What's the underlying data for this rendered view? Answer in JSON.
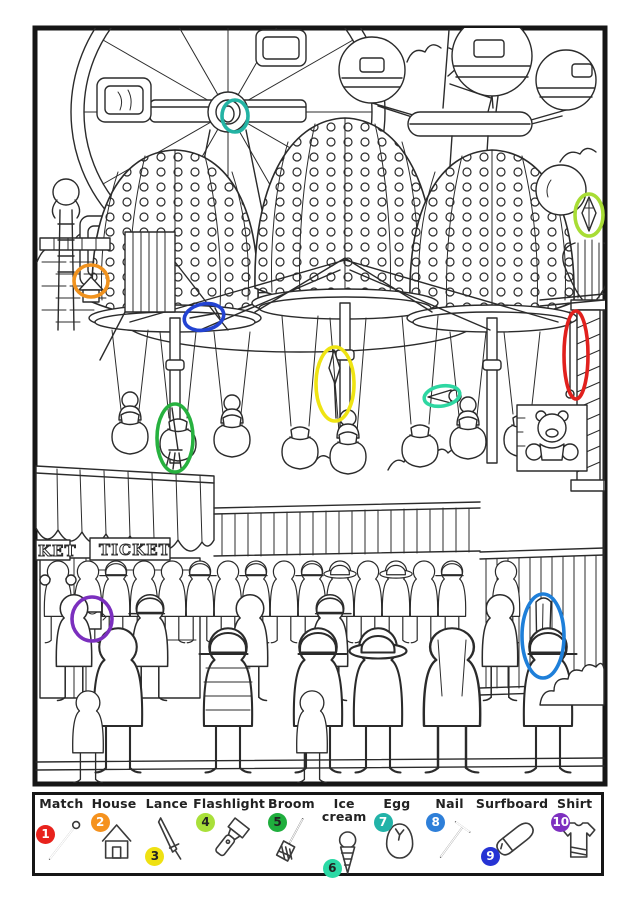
{
  "page": {
    "background": "#ffffff",
    "frame_color": "#161616",
    "type_label": "hidden objects coloring page - amusement park"
  },
  "scene": {
    "ticket_signs": {
      "left_partial": "KET",
      "main": "TICKET"
    },
    "markers": [
      {
        "number": 1,
        "item": "Match",
        "color": "#e1201d",
        "cx": 576,
        "cy": 355,
        "rx": 12,
        "ry": 44,
        "rotate": 0
      },
      {
        "number": 2,
        "item": "House",
        "color": "#f0921e",
        "cx": 91,
        "cy": 281,
        "rx": 17,
        "ry": 16,
        "rotate": 0
      },
      {
        "number": 3,
        "item": "Lance",
        "color": "#efe412",
        "cx": 335,
        "cy": 384,
        "rx": 19,
        "ry": 37,
        "rotate": 0
      },
      {
        "number": 4,
        "item": "Flashlight",
        "color": "#a8dd35",
        "cx": 589,
        "cy": 215,
        "rx": 14,
        "ry": 21,
        "rotate": 0
      },
      {
        "number": 5,
        "item": "Broom",
        "color": "#27b13f",
        "cx": 175,
        "cy": 438,
        "rx": 18,
        "ry": 34,
        "rotate": 0
      },
      {
        "number": 6,
        "item": "Ice cream",
        "color": "#2ed7a2",
        "cx": 442,
        "cy": 396,
        "rx": 18,
        "ry": 10,
        "rotate": -10
      },
      {
        "number": 7,
        "item": "Egg",
        "color": "#23b3a4",
        "cx": 235,
        "cy": 116,
        "rx": 13,
        "ry": 16,
        "rotate": 0
      },
      {
        "number": 8,
        "item": "Nail",
        "color": "#2343d2",
        "cx": 204,
        "cy": 317,
        "rx": 20,
        "ry": 13,
        "rotate": -12
      },
      {
        "number": 9,
        "item": "Surfboard",
        "color": "#1e7fd9",
        "cx": 543,
        "cy": 636,
        "rx": 21,
        "ry": 42,
        "rotate": 0
      },
      {
        "number": 10,
        "item": "Shirt",
        "color": "#7b2fbe",
        "cx": 92,
        "cy": 619,
        "rx": 20,
        "ry": 22,
        "rotate": 0
      }
    ]
  },
  "legend": {
    "items": [
      {
        "number": "1",
        "label": "Match",
        "color": "#e8221c",
        "number_color": "#ffffff",
        "icon": "match-icon"
      },
      {
        "number": "2",
        "label": "House",
        "color": "#f5921e",
        "number_color": "#ffffff",
        "icon": "house-icon"
      },
      {
        "number": "3",
        "label": "Lance",
        "color": "#efe112",
        "number_color": "#222222",
        "icon": "lance-icon"
      },
      {
        "number": "4",
        "label": "Flashlight",
        "color": "#a9e03a",
        "number_color": "#222222",
        "icon": "flashlight-icon"
      },
      {
        "number": "5",
        "label": "Broom",
        "color": "#1fae3d",
        "number_color": "#222222",
        "icon": "broom-icon"
      },
      {
        "number": "6",
        "label": "Ice cream",
        "color": "#2bd9a5",
        "number_color": "#222222",
        "icon": "ice-cream-icon"
      },
      {
        "number": "7",
        "label": "Egg",
        "color": "#22b3a8",
        "number_color": "#ffffff",
        "icon": "egg-icon"
      },
      {
        "number": "8",
        "label": "Nail",
        "color": "#2e7fd9",
        "number_color": "#ffffff",
        "icon": "nail-icon"
      },
      {
        "number": "9",
        "label": "Surfboard",
        "color": "#2633d4",
        "number_color": "#ffffff",
        "icon": "surfboard-icon"
      },
      {
        "number": "10",
        "label": "Shirt",
        "color": "#7d2fc0",
        "number_color": "#ffffff",
        "icon": "shirt-icon"
      }
    ]
  }
}
